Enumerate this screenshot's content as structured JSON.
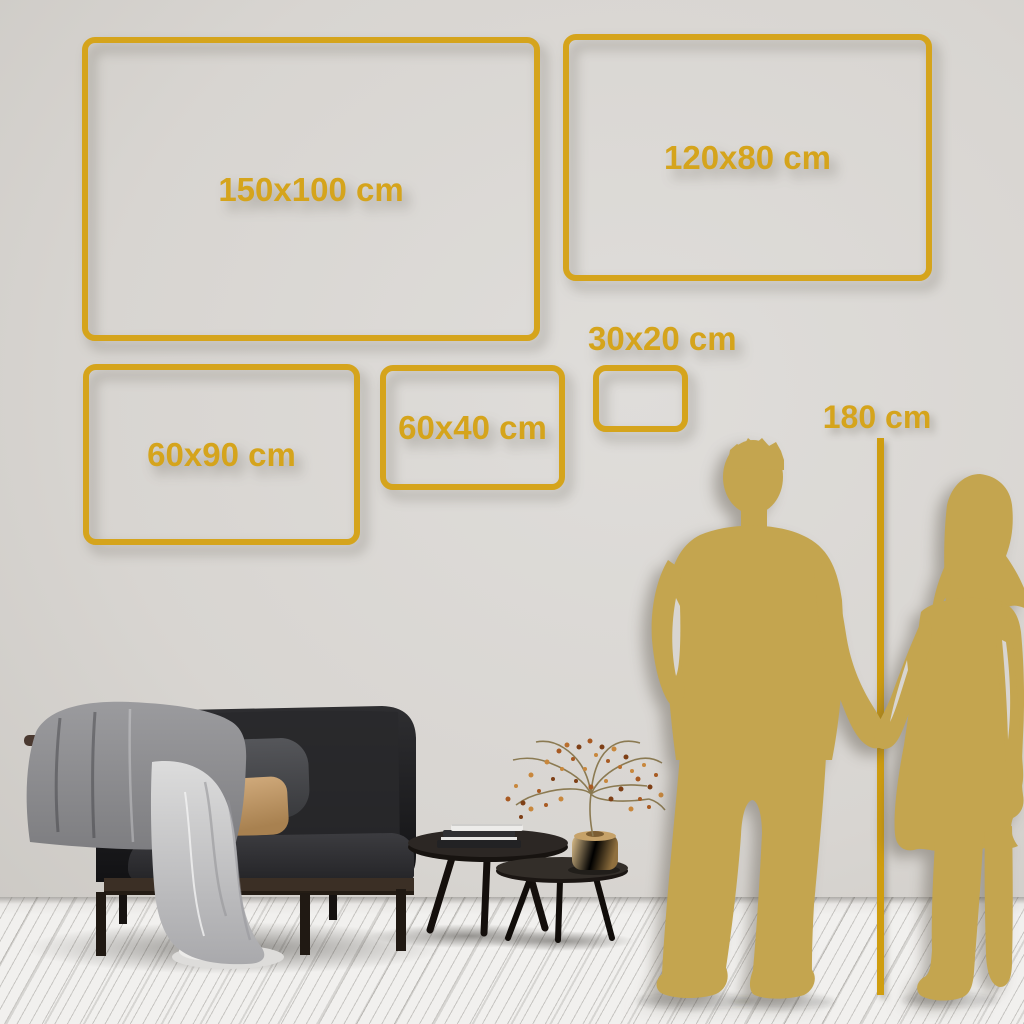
{
  "colors": {
    "gold": "#D5A41C",
    "line-gold": "#CF9D10",
    "silhouette": "#C4A54F",
    "wall": "#D8D5D1",
    "wall-light": "#DFDDDA",
    "wall-dark": "#C9C6C1",
    "floor": "#F1F0EE"
  },
  "frames": [
    {
      "name": "150x100",
      "label": "150x100 cm"
    },
    {
      "name": "120x80",
      "label": "120x80 cm"
    },
    {
      "name": "60x90",
      "label": "60x90 cm"
    },
    {
      "name": "60x40",
      "label": "60x40 cm"
    },
    {
      "name": "30x20",
      "label": "30x20 cm"
    }
  ],
  "height_marker": {
    "label": "180 cm"
  },
  "scene": {
    "left_objects": [
      "sofa",
      "throw-blanket",
      "back-pillow",
      "accent-pillow",
      "nesting-coffee-tables",
      "books",
      "brass-vase",
      "dried-plant"
    ],
    "right_objects": [
      "man-silhouette",
      "woman-silhouette",
      "height-reference-line"
    ]
  }
}
